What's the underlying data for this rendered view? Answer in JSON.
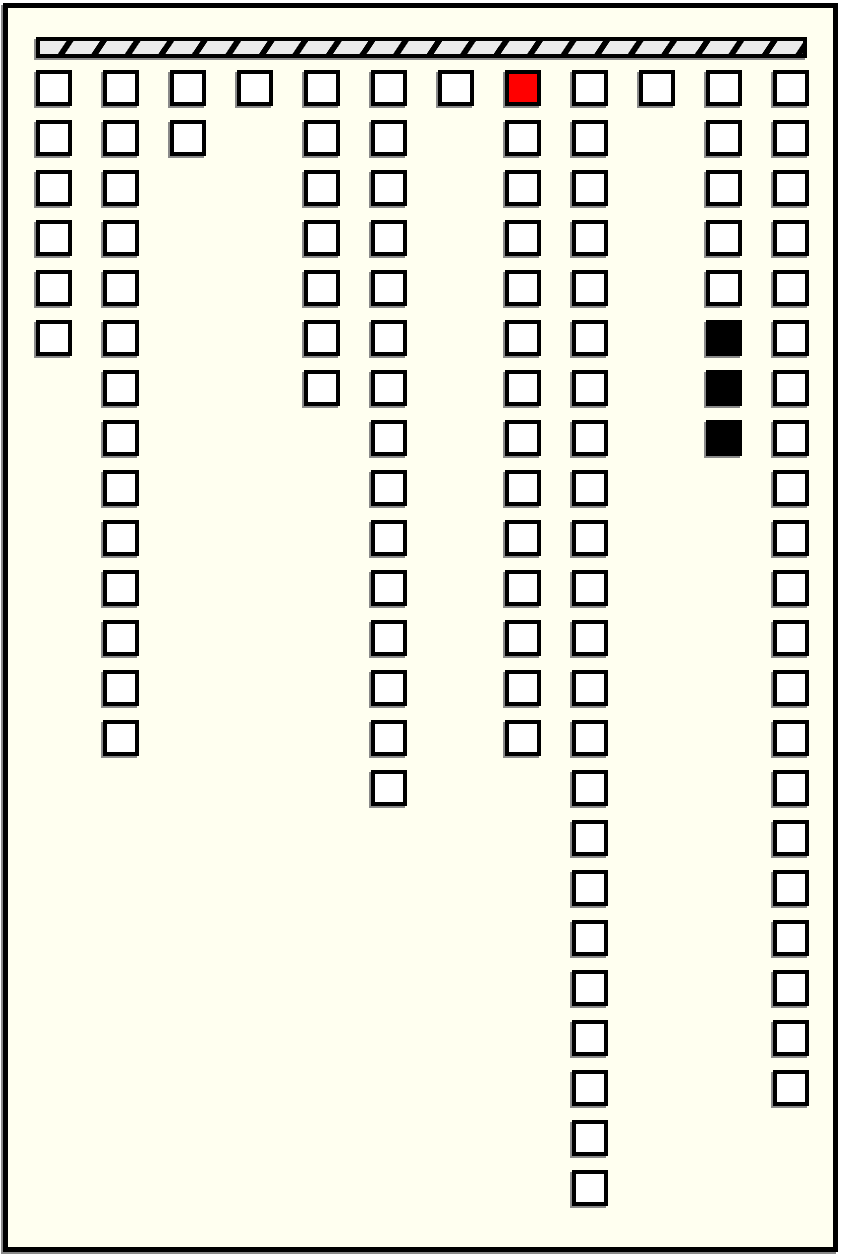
{
  "palette": {
    "background": "#FFFFF0",
    "page_border": "#000000",
    "bar_background": "#000000",
    "bar_stripe": "#EBEBEB",
    "cell_fill": "#FFFFFF",
    "cell_border": "#000000",
    "red_cell": "#FF0000",
    "black_cell": "#000000",
    "shadow": "#8A8A8A"
  },
  "board": {
    "column_count": 12,
    "max_rows": 23,
    "columns": [
      {
        "id": 1,
        "cells": 6
      },
      {
        "id": 2,
        "cells": 14
      },
      {
        "id": 3,
        "cells": 2
      },
      {
        "id": 4,
        "cells": 1
      },
      {
        "id": 5,
        "cells": 7
      },
      {
        "id": 6,
        "cells": 15
      },
      {
        "id": 7,
        "cells": 1
      },
      {
        "id": 8,
        "cells": 14
      },
      {
        "id": 9,
        "cells": 23
      },
      {
        "id": 10,
        "cells": 1
      },
      {
        "id": 11,
        "cells": 8
      },
      {
        "id": 12,
        "cells": 21
      }
    ],
    "highlighted_cells": [
      {
        "column": 8,
        "row": 1,
        "color": "red"
      },
      {
        "column": 11,
        "row": 6,
        "color": "black"
      },
      {
        "column": 11,
        "row": 7,
        "color": "black"
      },
      {
        "column": 11,
        "row": 8,
        "color": "black"
      }
    ]
  }
}
